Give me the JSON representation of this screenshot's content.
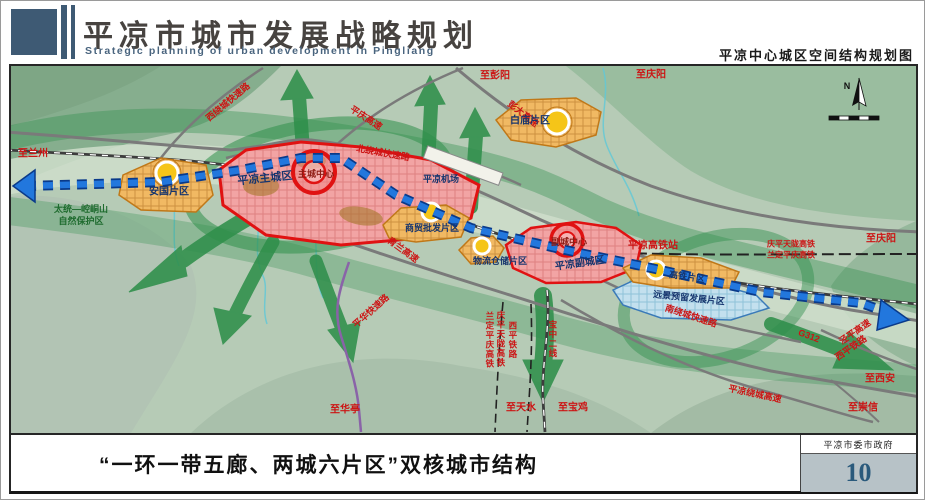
{
  "header": {
    "title_cn": "平凉市城市发展战略规划",
    "title_en": "Strategic planning of urban development in Pingliang",
    "map_title": "平凉中心城区空间结构规划图"
  },
  "map": {
    "compass_label": "N",
    "districts": {
      "main_city": "平凉主城区",
      "main_center": "主城中心",
      "sub_city": "平凉副城区",
      "sub_center": "副城中心",
      "baimiao": "白庙片区",
      "anguo": "安国片区",
      "shangmao": "商贸批发片区",
      "wuliu": "物流仓储片区",
      "gaotie": "高铁片区",
      "yuanjing": "远景预留发展片区"
    },
    "landmarks": {
      "airport": "平凉机场",
      "hsr_station": "平凉高铁站",
      "reserve_line1": "太统—崆峒山",
      "reserve_line2": "自然保护区"
    },
    "roads": {
      "xiraocheng": "西绕城快速路",
      "pingqing": "平庆高速",
      "pengda": "彭大高速",
      "beiraocheng": "北绕城快速路",
      "qinglan": "青兰高速",
      "pinghua": "平华快速路",
      "nanraocheng": "南绕城快速路",
      "raochenggaosu": "平凉绕城高速",
      "g312": "G312",
      "jingping": "泾平高速",
      "xiping_east": "西平铁路"
    },
    "railways": {
      "qingping_tianlong": "庆平天陇高铁",
      "landing_pingqing": "兰定平庆高铁",
      "xiping": "西平铁路",
      "baozhong2": "宝中二线"
    },
    "directions": {
      "lanzhou": "至兰州",
      "pengyang": "至彭阳",
      "qingyang_top": "至庆阳",
      "qingyang_right": "至庆阳",
      "xian": "至西安",
      "chongxin": "至崇信",
      "huating": "至华亭",
      "tianshui": "至天水",
      "baoji": "至宝鸡"
    }
  },
  "footer": {
    "caption": "“一环一带五廊、两城六片区”双核城市结构",
    "agency": "平凉市委市政府",
    "page_number": "10"
  },
  "colors": {
    "header_slate": "#3e5a74",
    "corridor_green": "#2f8f4b",
    "axis_blue": "#2277dd",
    "city_red": "#e01212",
    "area_orange": "#f1b963",
    "area_blue": "#c3e0ee"
  }
}
